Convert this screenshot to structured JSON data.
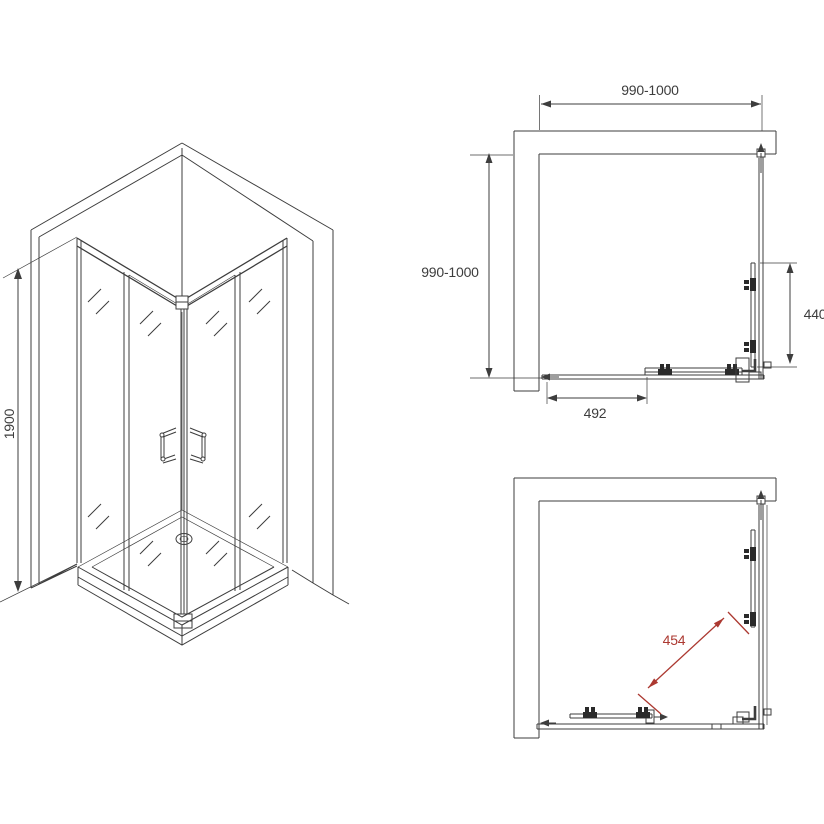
{
  "colors": {
    "line": "#3d3d3d",
    "accent_red": "#ac3931",
    "brick_line": "#6a6a6a",
    "background": "#ffffff"
  },
  "views": {
    "isometric": {
      "dimensions": {
        "height": "1900"
      }
    },
    "plan_top": {
      "dimensions": {
        "width": "990-1000",
        "depth": "990-1000",
        "side_panel": "440",
        "door_opening": "492"
      }
    },
    "plan_bottom": {
      "dimensions": {
        "door_diagonal": "454"
      }
    }
  }
}
